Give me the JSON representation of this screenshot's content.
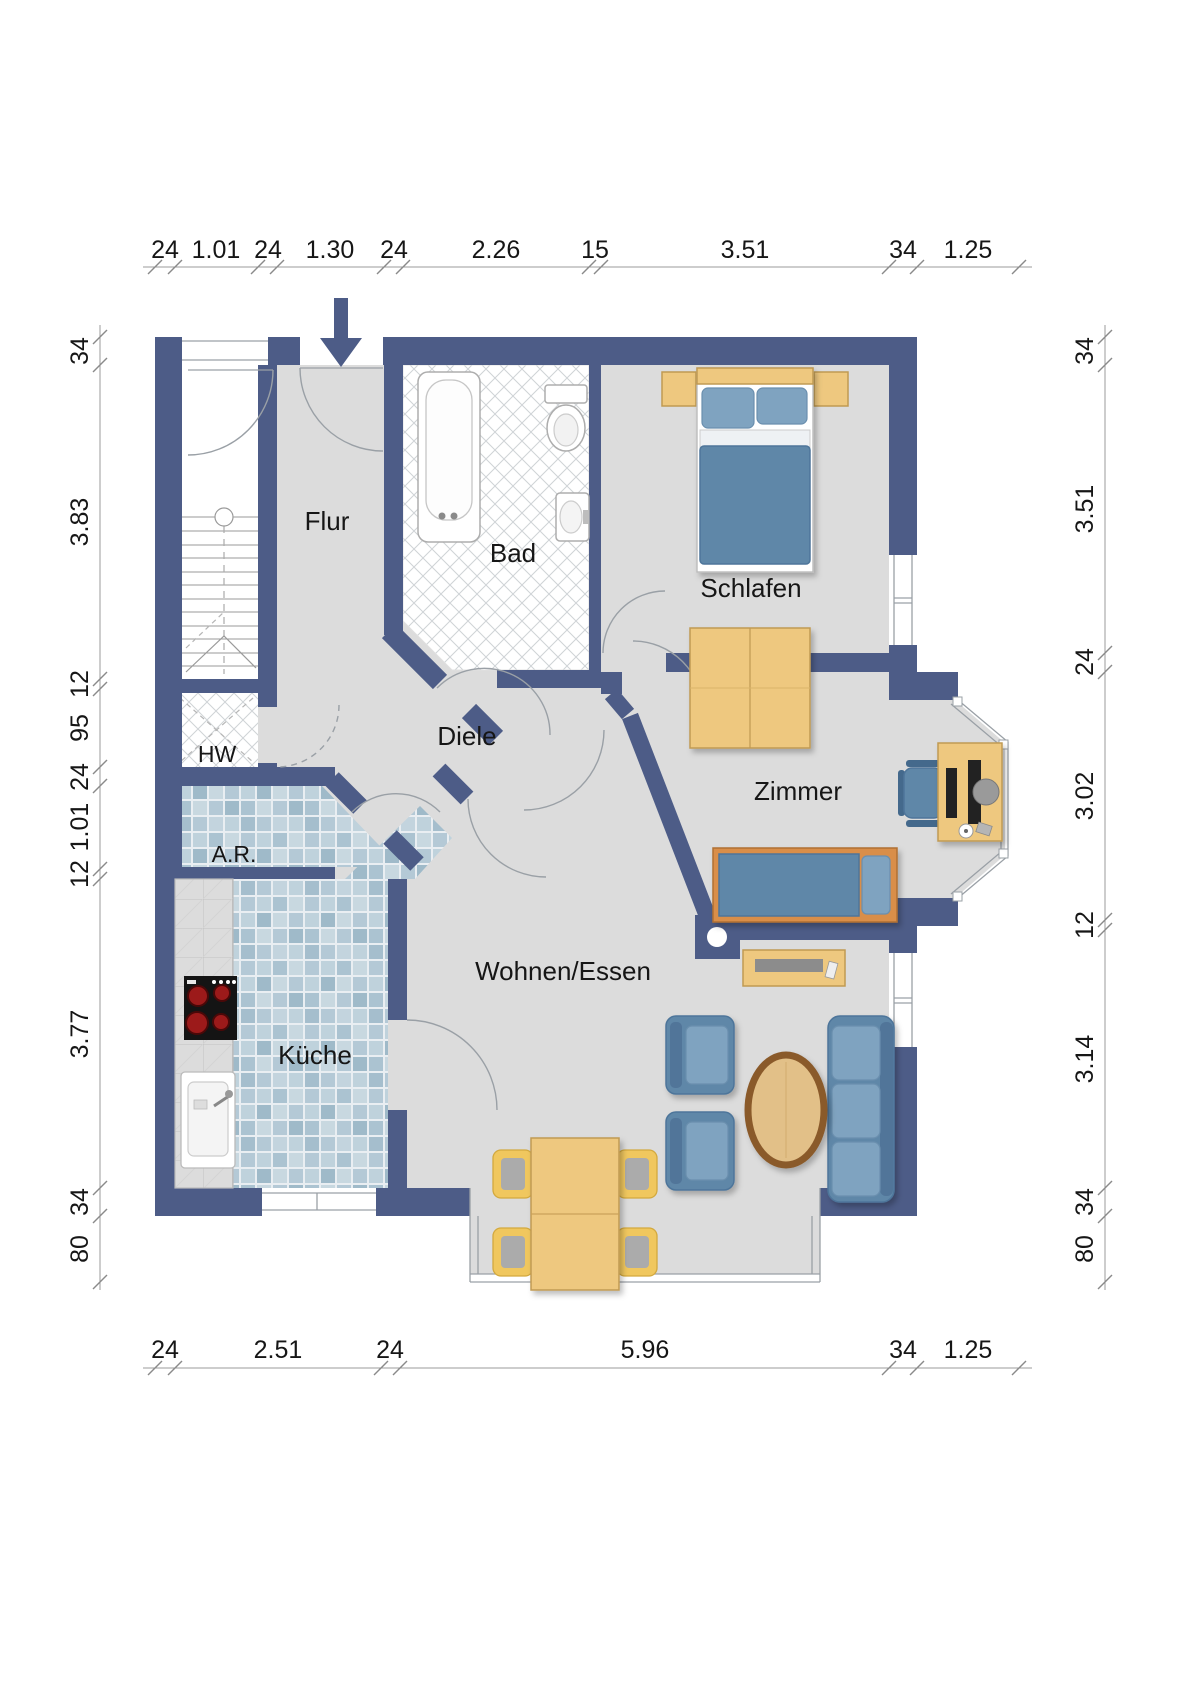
{
  "rooms": {
    "flur": "Flur",
    "bad": "Bad",
    "schlafen": "Schlafen",
    "diele": "Diele",
    "hw": "HW",
    "ar": "A.R.",
    "zimmer": "Zimmer",
    "kueche": "Küche",
    "wohnen": "Wohnen/Essen"
  },
  "dims": {
    "top": [
      "24",
      "1.01",
      "24",
      "1.30",
      "24",
      "2.26",
      "15",
      "3.51",
      "34",
      "1.25"
    ],
    "bottom": [
      "24",
      "2.51",
      "24",
      "5.96",
      "34",
      "1.25"
    ],
    "left": [
      "34",
      "3.83",
      "12",
      "95",
      "24",
      "1.01",
      "12",
      "3.77",
      "34",
      "80"
    ],
    "right": [
      "34",
      "3.51",
      "24",
      "3.02",
      "12",
      "3.14",
      "34",
      "80"
    ]
  },
  "colors": {
    "wall": "#4d5c87",
    "floor": "#dcdcdc",
    "wood": "#eec87f",
    "wood_dark": "#8a5a2b",
    "upholstery": "#5f87a8",
    "upholstery_light": "#7fa3c0",
    "tile_blue": "#b7cbd8",
    "chair_yellow": "#f0c75e",
    "burner_red": "#9c1a1a",
    "line_gray": "#9aa0a6"
  }
}
